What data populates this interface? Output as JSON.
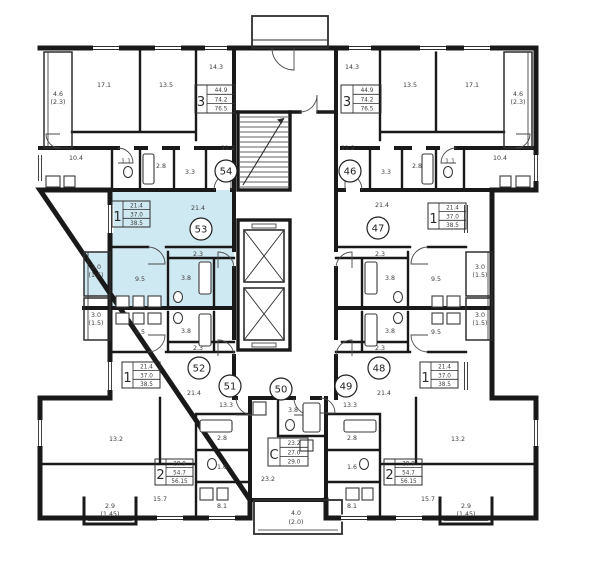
{
  "plan_title": "Residential floor plan, apartments 46-54",
  "colors": {
    "wall": "#191919",
    "highlight": "#cfe9f2",
    "text": "#3d3d3d"
  },
  "apartments": {
    "a54": {
      "num": "54",
      "type": "3",
      "areas": {
        "living": "44.9",
        "usable": "74.2",
        "total": "76.5"
      },
      "rooms": {
        "room1": "17.1",
        "room2": "13.5",
        "room3": "14.3",
        "loggia": "4.6",
        "loggia2": "(2.3)",
        "kitchen": "10.4",
        "wc": "1.1",
        "bath": "2.8",
        "store": "3.3",
        "hall": "11.2"
      }
    },
    "a46": {
      "num": "46",
      "type": "3",
      "areas": {
        "living": "44.9",
        "usable": "74.2",
        "total": "76.5"
      },
      "rooms": {
        "room1": "17.1",
        "room2": "13.5",
        "room3": "14.3",
        "loggia": "4.6",
        "loggia2": "(2.3)",
        "kitchen": "10.4",
        "wc": "1.1",
        "bath": "2.8",
        "store": "3.3",
        "hall": "11.2"
      }
    },
    "a53": {
      "num": "53",
      "type": "1",
      "areas": {
        "living": "21.4",
        "usable": "37.0",
        "total": "38.5"
      },
      "rooms": {
        "living": "21.4",
        "hall": "2.3",
        "kitchen": "9.5",
        "bath": "3.8",
        "loggia": "3.0",
        "loggia2": "(1.5)"
      }
    },
    "a52": {
      "num": "52",
      "type": "1",
      "areas": {
        "living": "21.4",
        "usable": "37.0",
        "total": "38.5"
      },
      "rooms": {
        "living": "21.4",
        "hall": "2.3",
        "kitchen": "9.5",
        "bath": "3.8",
        "loggia": "3.0",
        "loggia2": "(1.5)"
      }
    },
    "a47": {
      "num": "47",
      "type": "1",
      "areas": {
        "living": "21.4",
        "usable": "37.0",
        "total": "38.5"
      },
      "rooms": {
        "living": "21.4",
        "hall": "2.3",
        "kitchen": "9.5",
        "bath": "3.8",
        "loggia": "3.0",
        "loggia2": "(1.5)"
      }
    },
    "a48": {
      "num": "48",
      "type": "1",
      "areas": {
        "living": "21.4",
        "usable": "37.0",
        "total": "38.5"
      },
      "rooms": {
        "living": "21.4",
        "hall": "2.3",
        "kitchen": "9.5",
        "bath": "3.8",
        "loggia": "3.0",
        "loggia2": "(1.5)"
      }
    },
    "a51": {
      "num": "51",
      "type": "2",
      "areas": {
        "living": "28.9",
        "usable": "54.7",
        "total": "56.15"
      },
      "rooms": {
        "hall": "13.3",
        "room1": "13.2",
        "room2": "15.7",
        "kitchen": "8.1",
        "bath": "2.8",
        "wc": "1.6",
        "balcony": "2.9",
        "balcony2": "(1.45)"
      }
    },
    "a49": {
      "num": "49",
      "type": "2",
      "areas": {
        "living": "28.9",
        "usable": "54.7",
        "total": "56.15"
      },
      "rooms": {
        "hall": "13.3",
        "room1": "13.2",
        "room2": "15.7",
        "kitchen": "8.1",
        "bath": "2.8",
        "wc": "1.6",
        "balcony": "2.9",
        "balcony2": "(1.45)"
      }
    },
    "a50": {
      "num": "50",
      "type": "С",
      "areas": {
        "living": "23.2",
        "usable": "27.0",
        "total": "29.0"
      },
      "rooms": {
        "living": "23.2",
        "bath": "3.8",
        "balcony": "4.0",
        "balcony2": "(2.0)"
      }
    }
  }
}
